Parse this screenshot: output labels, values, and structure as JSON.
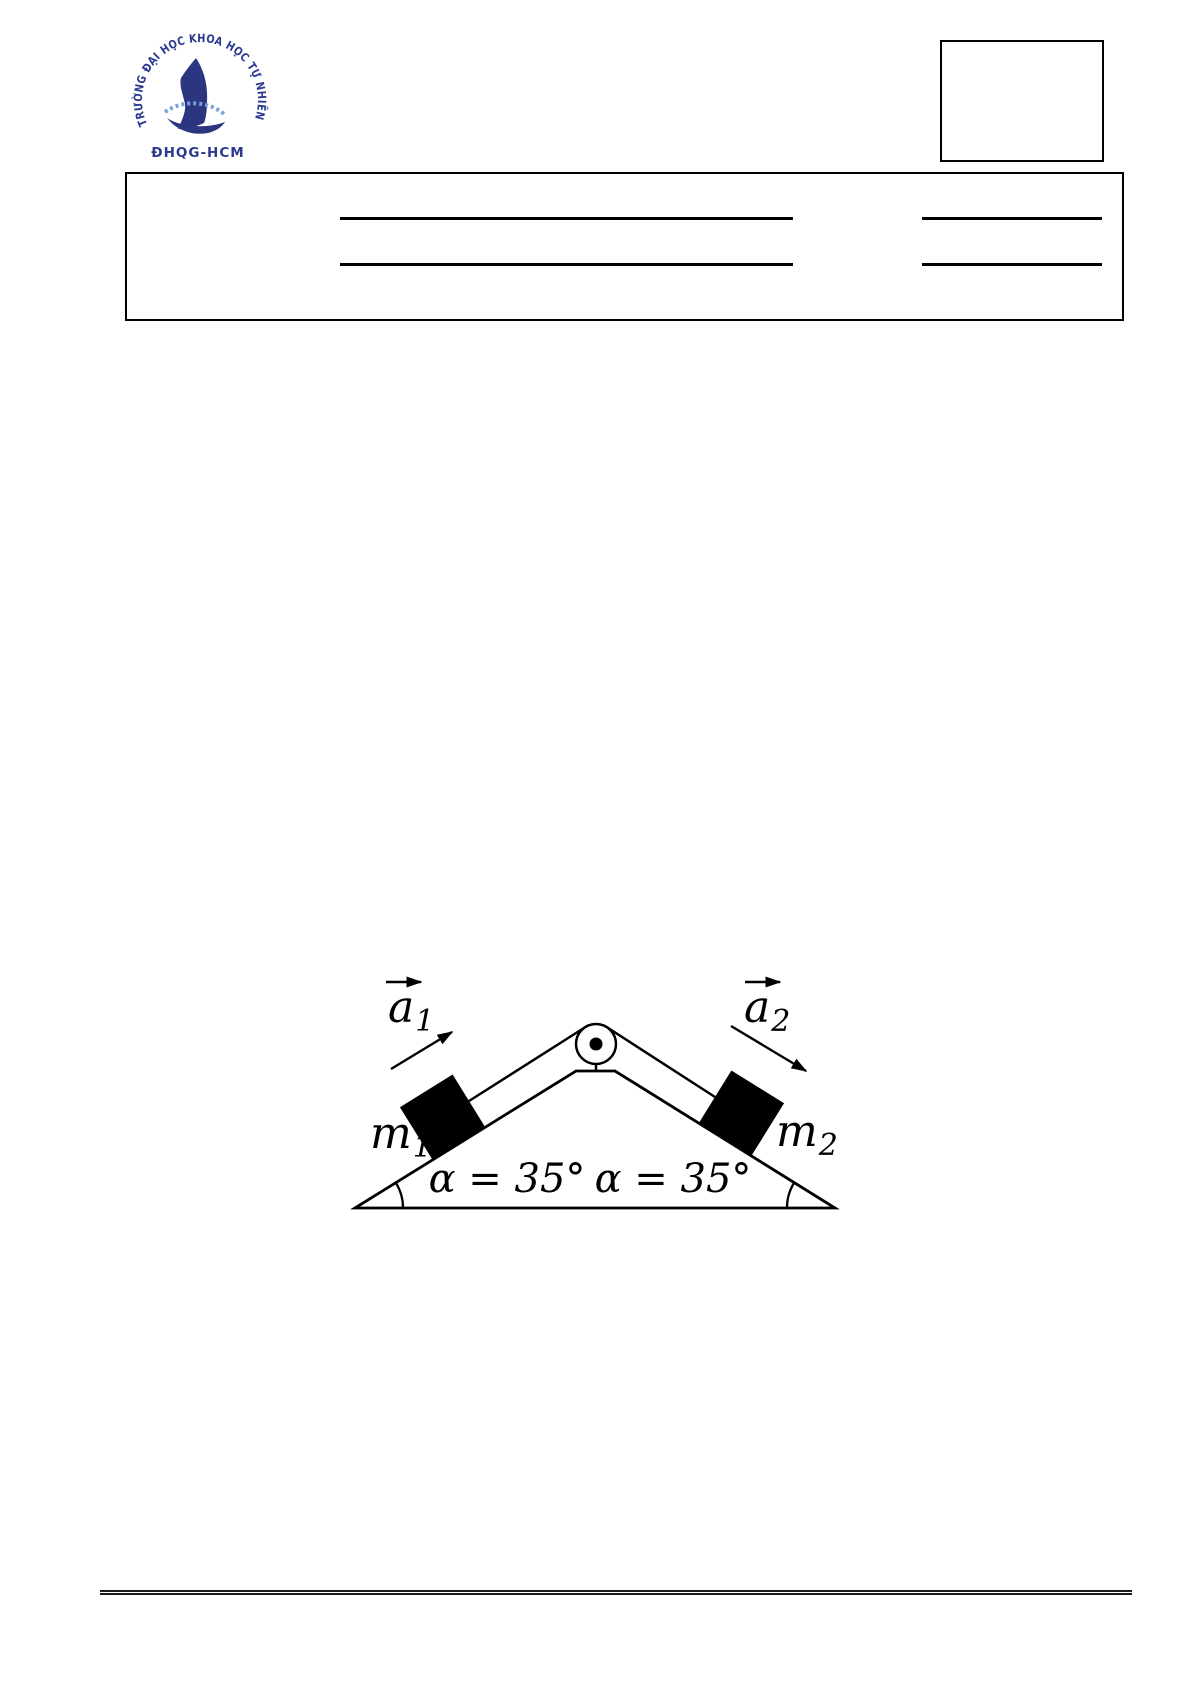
{
  "page": {
    "width": 1192,
    "height": 1685,
    "background": "#ffffff"
  },
  "logo": {
    "circular_text": "TRƯỜNG ĐẠI HỌC KHOA HỌC TỰ NHIÊN",
    "subtitle": "ĐHQG-HCM",
    "color": "#2b3990"
  },
  "header": {
    "corner_box": {
      "content": ""
    },
    "info_box": {
      "blank_line_count": 4
    }
  },
  "diagram": {
    "type": "double-incline-pulley",
    "incline_angle_deg": 35,
    "ink_color": "#000000",
    "labels": {
      "a1": {
        "symbol": "a",
        "subscript": "1"
      },
      "a2": {
        "symbol": "a",
        "subscript": "2"
      },
      "m1": {
        "symbol": "m",
        "subscript": "1"
      },
      "m2": {
        "symbol": "m",
        "subscript": "2"
      },
      "angle_left": "α = 35°",
      "angle_right": "α = 35°"
    }
  }
}
